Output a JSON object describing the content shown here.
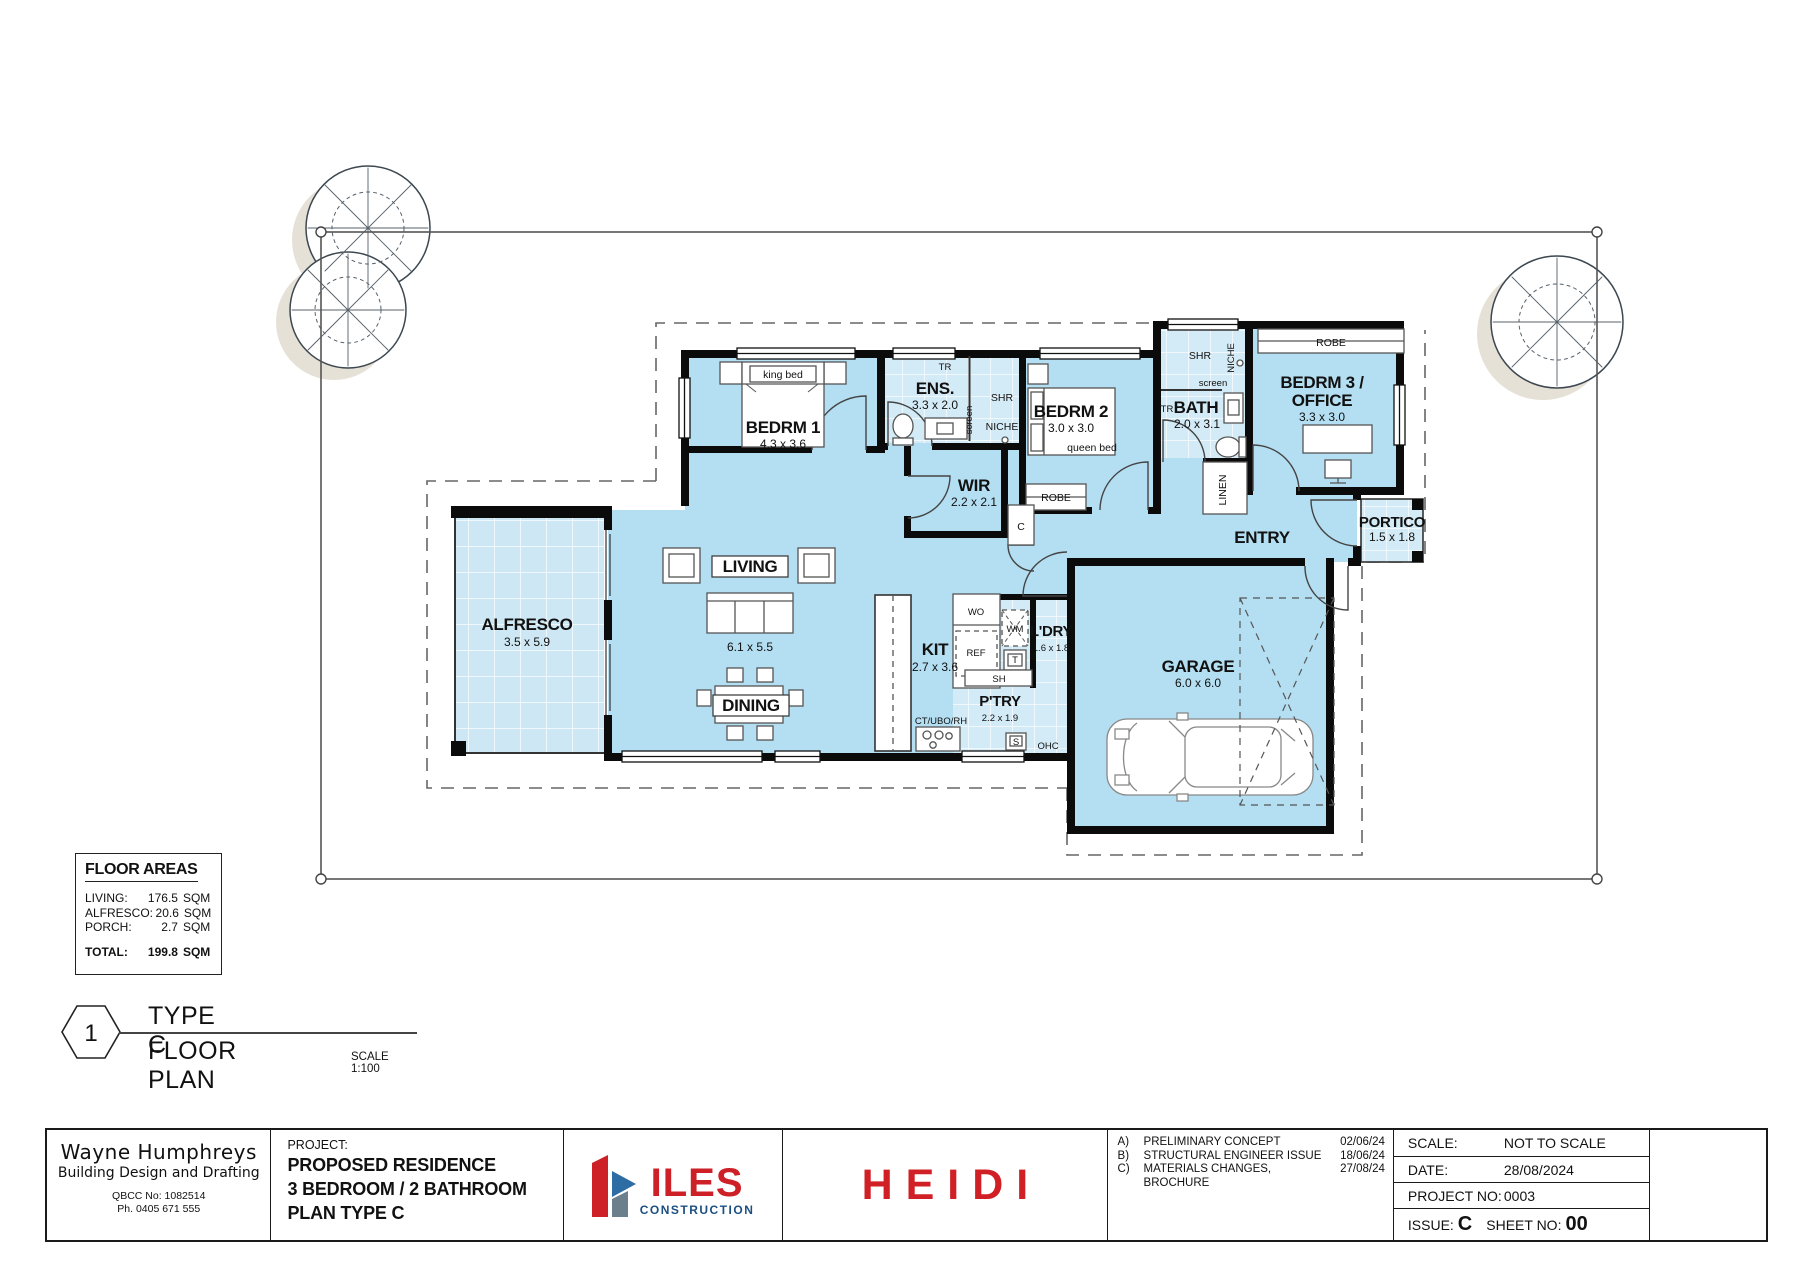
{
  "plan": {
    "rooms": {
      "bedrm1": {
        "label": "BEDRM 1",
        "dim": "4.3 x 3.6"
      },
      "ens": {
        "label": "ENS.",
        "dim": "3.3 x 2.0"
      },
      "wir": {
        "label": "WIR",
        "dim": "2.2 x 2.1"
      },
      "bedrm2": {
        "label": "BEDRM 2",
        "dim": "3.0 x 3.0"
      },
      "bath": {
        "label": "BATH",
        "dim": "2.0 x 3.1"
      },
      "bedrm3": {
        "label1": "BEDRM 3 /",
        "label2": "OFFICE",
        "dim": "3.3 x 3.0"
      },
      "entry": {
        "label": "ENTRY"
      },
      "portico": {
        "label": "PORTICO",
        "dim": "1.5 x 1.8"
      },
      "alfresco": {
        "label": "ALFRESCO",
        "dim": "3.5 x 5.9"
      },
      "living": {
        "label": "LIVING",
        "dim": "6.1 x 5.5"
      },
      "dining": {
        "label": "DINING"
      },
      "kit": {
        "label": "KIT",
        "dim": "2.7 x 3.6"
      },
      "ptry": {
        "label": "P'TRY",
        "dim": "2.2 x 1.9"
      },
      "ldry": {
        "label": "L'DRY",
        "dim": "1.6 x 1.8"
      },
      "garage": {
        "label": "GARAGE",
        "dim": "6.0 x 6.0"
      }
    },
    "fixtures": {
      "king_bed": "king bed",
      "queen_bed": "queen bed",
      "robe": "ROBE",
      "shr": "SHR",
      "niche": "NICHE",
      "screen": "screen",
      "tr": "TR",
      "linen": "LINEN",
      "cupboard": "C",
      "wo": "WO",
      "ref": "REF",
      "wm": "WM",
      "tub": "T",
      "sh": "SH",
      "sink": "S",
      "ohc": "OHC",
      "ct": "CT/UBO/RH"
    },
    "colors": {
      "room_fill": "#b4def1",
      "wet_fill": "#d3ebf6",
      "wall": "#0b0b0b"
    }
  },
  "floor_areas": {
    "title": "FLOOR AREAS",
    "rows": [
      {
        "label": "LIVING:",
        "value": "176.5",
        "unit": "SQM"
      },
      {
        "label": "ALFRESCO:",
        "value": "20.6",
        "unit": "SQM"
      },
      {
        "label": "PORCH:",
        "value": "2.7",
        "unit": "SQM"
      }
    ],
    "total": {
      "label": "TOTAL:",
      "value": "199.8",
      "unit": "SQM"
    }
  },
  "title_ref": {
    "number": "1",
    "line1": "TYPE C",
    "line2": "FLOOR PLAN",
    "scale": "SCALE 1:100"
  },
  "title_block": {
    "designer": {
      "name": "Wayne Humphreys",
      "tagline": "Building Design and Drafting",
      "qbcc": "QBCC No: 1082514",
      "phone": "Ph. 0405 671 555"
    },
    "project": {
      "heading": "PROJECT:",
      "line1": "PROPOSED RESIDENCE",
      "line2": "3 BEDROOM / 2 BATHROOM",
      "line3": "PLAN TYPE C"
    },
    "logo": {
      "name": "ILES",
      "sub": "CONSTRUCTION",
      "red": "#cd2027",
      "navy": "#1b4f82"
    },
    "client": {
      "name": "HEIDI"
    },
    "revisions": [
      {
        "id": "A)",
        "desc": "PRELIMINARY CONCEPT",
        "date": "02/06/24"
      },
      {
        "id": "B)",
        "desc": "STRUCTURAL ENGINEER ISSUE",
        "date": "18/06/24"
      },
      {
        "id": "C)",
        "desc": "MATERIALS CHANGES, BROCHURE",
        "date": "27/08/24"
      }
    ],
    "meta": {
      "scale_label": "SCALE:",
      "scale": "NOT TO SCALE",
      "date_label": "DATE:",
      "date": "28/08/2024",
      "project_no_label": "PROJECT NO:",
      "project_no": "0003",
      "issue_label": "ISSUE:",
      "issue": "C",
      "sheet_label": "SHEET NO:",
      "sheet": "00"
    }
  }
}
